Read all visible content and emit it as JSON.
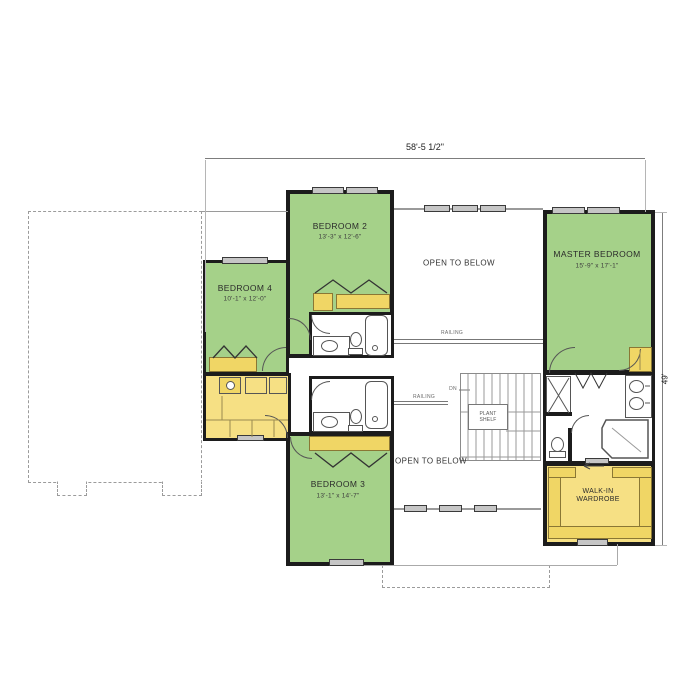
{
  "dimensions": {
    "width_top": "58'-5 1/2\"",
    "height_right": "49'"
  },
  "rooms": {
    "bedroom_2": {
      "name": "BEDROOM 2",
      "size": "13'-3\" x 12'-6\""
    },
    "bedroom_3": {
      "name": "BEDROOM 3",
      "size": "13'-1\" x 14'-7\""
    },
    "bedroom_4": {
      "name": "BEDROOM 4",
      "size": "10'-1\" x 12'-0\""
    },
    "master_bedroom": {
      "name": "MASTER BEDROOM",
      "size": "15'-9\" x 17'-1\""
    },
    "walk_in_wardrobe": {
      "name_line1": "WALK-IN",
      "name_line2": "WARDROBE"
    },
    "open_to_below_upper": {
      "name": "OPEN TO BELOW"
    },
    "open_to_below_lower": {
      "name": "OPEN TO BELOW"
    }
  },
  "annotations": {
    "railing_upper": "RAILING",
    "railing_lower": "RAILING",
    "stairs_direction": "DN",
    "plant_shelf_line1": "PLANT",
    "plant_shelf_line2": "SHELF"
  },
  "colors": {
    "bedroom_fill": "#a5d189",
    "closet_fill": "#f6e084",
    "shelf_fill": "#f0d665",
    "wall": "#1c1c1c"
  }
}
